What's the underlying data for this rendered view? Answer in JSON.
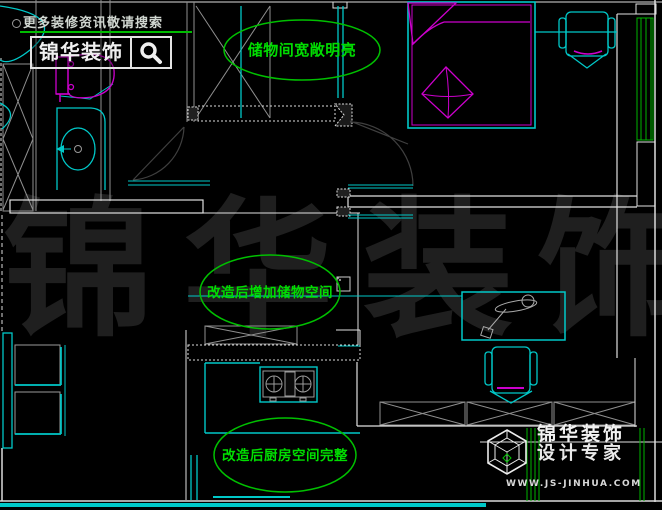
{
  "header": {
    "search_hint": "更多装修资讯敬请搜索",
    "logo_text": "锦华装饰"
  },
  "annotations": {
    "storage_room": "储物间宽敞明亮",
    "added_storage": "改造后增加储物空间",
    "kitchen": "改造后厨房空间完整"
  },
  "watermark": {
    "characters": [
      "锦",
      "华",
      "装",
      "饰"
    ]
  },
  "footer": {
    "company": "锦华装饰",
    "tagline": "设计专家",
    "website": "WWW.JS-JINHUA.COM"
  },
  "icons": {
    "search": "magnifier",
    "footer_logo": "wireframe-cube"
  },
  "colors": {
    "background": "#000000",
    "cad_cyan": "#00c8c8",
    "cad_magenta": "#cc00cc",
    "annotation_green": "#00dd00",
    "curtain_green": "#00b400",
    "wall_white": "#e0e0e0",
    "wall_grey": "#8f8f8f",
    "door_grey": "#3f3f3f",
    "watermark_grey": "#1f1f1f"
  }
}
